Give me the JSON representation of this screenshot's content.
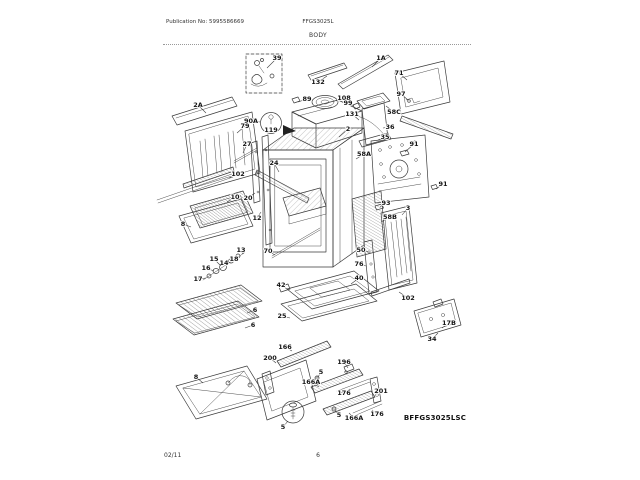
{
  "page": {
    "publication": "Publication No: 5995586669",
    "model": "FFGS3025L",
    "section_title": "BODY",
    "diagram_code": "BFFGS3025LSC",
    "footer_date": "02/11",
    "footer_page": "6"
  },
  "diagram": {
    "description": "Exploded parts diagram of gas range body",
    "callouts": [
      {
        "t": "39",
        "x": 277,
        "y": 58,
        "lx": 267,
        "ly": 68
      },
      {
        "t": "132",
        "x": 318,
        "y": 82,
        "lx": 327,
        "ly": 76
      },
      {
        "t": "1A",
        "x": 381,
        "y": 58,
        "lx": 372,
        "ly": 67
      },
      {
        "t": "71",
        "x": 399,
        "y": 73,
        "lx": 407,
        "ly": 80
      },
      {
        "t": "97",
        "x": 401,
        "y": 94,
        "lx": 408,
        "ly": 100
      },
      {
        "t": "89",
        "x": 307,
        "y": 99,
        "lx": 298,
        "ly": 102
      },
      {
        "t": "108",
        "x": 344,
        "y": 98,
        "lx": 336,
        "ly": 101
      },
      {
        "t": "90A",
        "x": 251,
        "y": 121,
        "lx": 260,
        "ly": 122
      },
      {
        "t": "119",
        "x": 271,
        "y": 130
      },
      {
        "t": "2A",
        "x": 198,
        "y": 105,
        "lx": 206,
        "ly": 113
      },
      {
        "t": "79",
        "x": 245,
        "y": 126,
        "lx": 237,
        "ly": 133
      },
      {
        "t": "27",
        "x": 247,
        "y": 144,
        "lx": 243,
        "ly": 153
      },
      {
        "t": "102",
        "x": 238,
        "y": 174,
        "lx": 229,
        "ly": 178
      },
      {
        "t": "10",
        "x": 235,
        "y": 197,
        "lx": 227,
        "ly": 202
      },
      {
        "t": "8",
        "x": 183,
        "y": 224,
        "lx": 191,
        "ly": 227
      },
      {
        "t": "99",
        "x": 348,
        "y": 103,
        "lx": 354,
        "ly": 106
      },
      {
        "t": "131",
        "x": 352,
        "y": 114,
        "lx": 359,
        "ly": 120
      },
      {
        "t": "2",
        "x": 348,
        "y": 129,
        "lx": 339,
        "ly": 137
      },
      {
        "t": "58C",
        "x": 394,
        "y": 112,
        "lx": 386,
        "ly": 106
      },
      {
        "t": "36",
        "x": 390,
        "y": 127,
        "lx": 383,
        "ly": 128
      },
      {
        "t": "35",
        "x": 385,
        "y": 137,
        "lx": 378,
        "ly": 140
      },
      {
        "t": "58A",
        "x": 364,
        "y": 154,
        "lx": 356,
        "ly": 159
      },
      {
        "t": "91",
        "x": 414,
        "y": 144,
        "lx": 405,
        "ly": 152
      },
      {
        "t": "91",
        "x": 443,
        "y": 184,
        "lx": 436,
        "ly": 189
      },
      {
        "t": "93",
        "x": 386,
        "y": 203,
        "lx": 380,
        "ly": 207
      },
      {
        "t": "3",
        "x": 408,
        "y": 208,
        "lx": 402,
        "ly": 215
      },
      {
        "t": "58B",
        "x": 390,
        "y": 217,
        "lx": 381,
        "ly": 222
      },
      {
        "t": "50",
        "x": 361,
        "y": 250,
        "lx": 368,
        "ly": 252
      },
      {
        "t": "76",
        "x": 359,
        "y": 264,
        "lx": 366,
        "ly": 266
      },
      {
        "t": "40",
        "x": 359,
        "y": 278,
        "lx": 351,
        "ly": 284
      },
      {
        "t": "102",
        "x": 408,
        "y": 298,
        "lx": 399,
        "ly": 292
      },
      {
        "t": "17B",
        "x": 449,
        "y": 323,
        "lx": 442,
        "ly": 328
      },
      {
        "t": "34",
        "x": 432,
        "y": 339,
        "lx": 438,
        "ly": 333
      },
      {
        "t": "24",
        "x": 274,
        "y": 163,
        "lx": 279,
        "ly": 172
      },
      {
        "t": "20",
        "x": 248,
        "y": 198,
        "lx": 255,
        "ly": 193
      },
      {
        "t": "12",
        "x": 257,
        "y": 218,
        "lx": 261,
        "ly": 212
      },
      {
        "t": "13",
        "x": 241,
        "y": 250,
        "lx": 243,
        "ly": 253
      },
      {
        "t": "18",
        "x": 234,
        "y": 259,
        "lx": 237,
        "ly": 257
      },
      {
        "t": "14",
        "x": 224,
        "y": 263,
        "lx": 229,
        "ly": 262
      },
      {
        "t": "15",
        "x": 214,
        "y": 259,
        "lx": 221,
        "ly": 266
      },
      {
        "t": "16",
        "x": 206,
        "y": 268,
        "lx": 214,
        "ly": 271
      },
      {
        "t": "17",
        "x": 198,
        "y": 279,
        "lx": 206,
        "ly": 278
      },
      {
        "t": "70",
        "x": 268,
        "y": 251,
        "lx": 275,
        "ly": 255
      },
      {
        "t": "42",
        "x": 281,
        "y": 285,
        "lx": 287,
        "ly": 289
      },
      {
        "t": "25",
        "x": 282,
        "y": 316,
        "lx": 290,
        "ly": 318
      },
      {
        "t": "166",
        "x": 285,
        "y": 347,
        "lx": 292,
        "ly": 351
      },
      {
        "t": "200",
        "x": 270,
        "y": 358,
        "lx": 276,
        "ly": 363
      },
      {
        "t": "166A",
        "x": 311,
        "y": 382,
        "lx": 319,
        "ly": 387
      },
      {
        "t": "196",
        "x": 344,
        "y": 362,
        "lx": 348,
        "ly": 368
      },
      {
        "t": "176",
        "x": 344,
        "y": 393,
        "lx": 350,
        "ly": 389
      },
      {
        "t": "201",
        "x": 381,
        "y": 391,
        "lx": 376,
        "ly": 394
      },
      {
        "t": "166A",
        "x": 354,
        "y": 418,
        "lx": 349,
        "ly": 413
      },
      {
        "t": "176",
        "x": 377,
        "y": 414,
        "lx": 372,
        "ly": 410
      },
      {
        "t": "5",
        "x": 321,
        "y": 372,
        "lx": 318,
        "ly": 377
      },
      {
        "t": "5",
        "x": 339,
        "y": 415,
        "lx": 335,
        "ly": 411
      },
      {
        "t": "5",
        "x": 283,
        "y": 427,
        "lx": 288,
        "ly": 421
      },
      {
        "t": "8",
        "x": 196,
        "y": 377,
        "lx": 203,
        "ly": 383
      },
      {
        "t": "6",
        "x": 255,
        "y": 310,
        "lx": 247,
        "ly": 313
      },
      {
        "t": "6",
        "x": 253,
        "y": 325,
        "lx": 245,
        "ly": 328
      }
    ]
  }
}
